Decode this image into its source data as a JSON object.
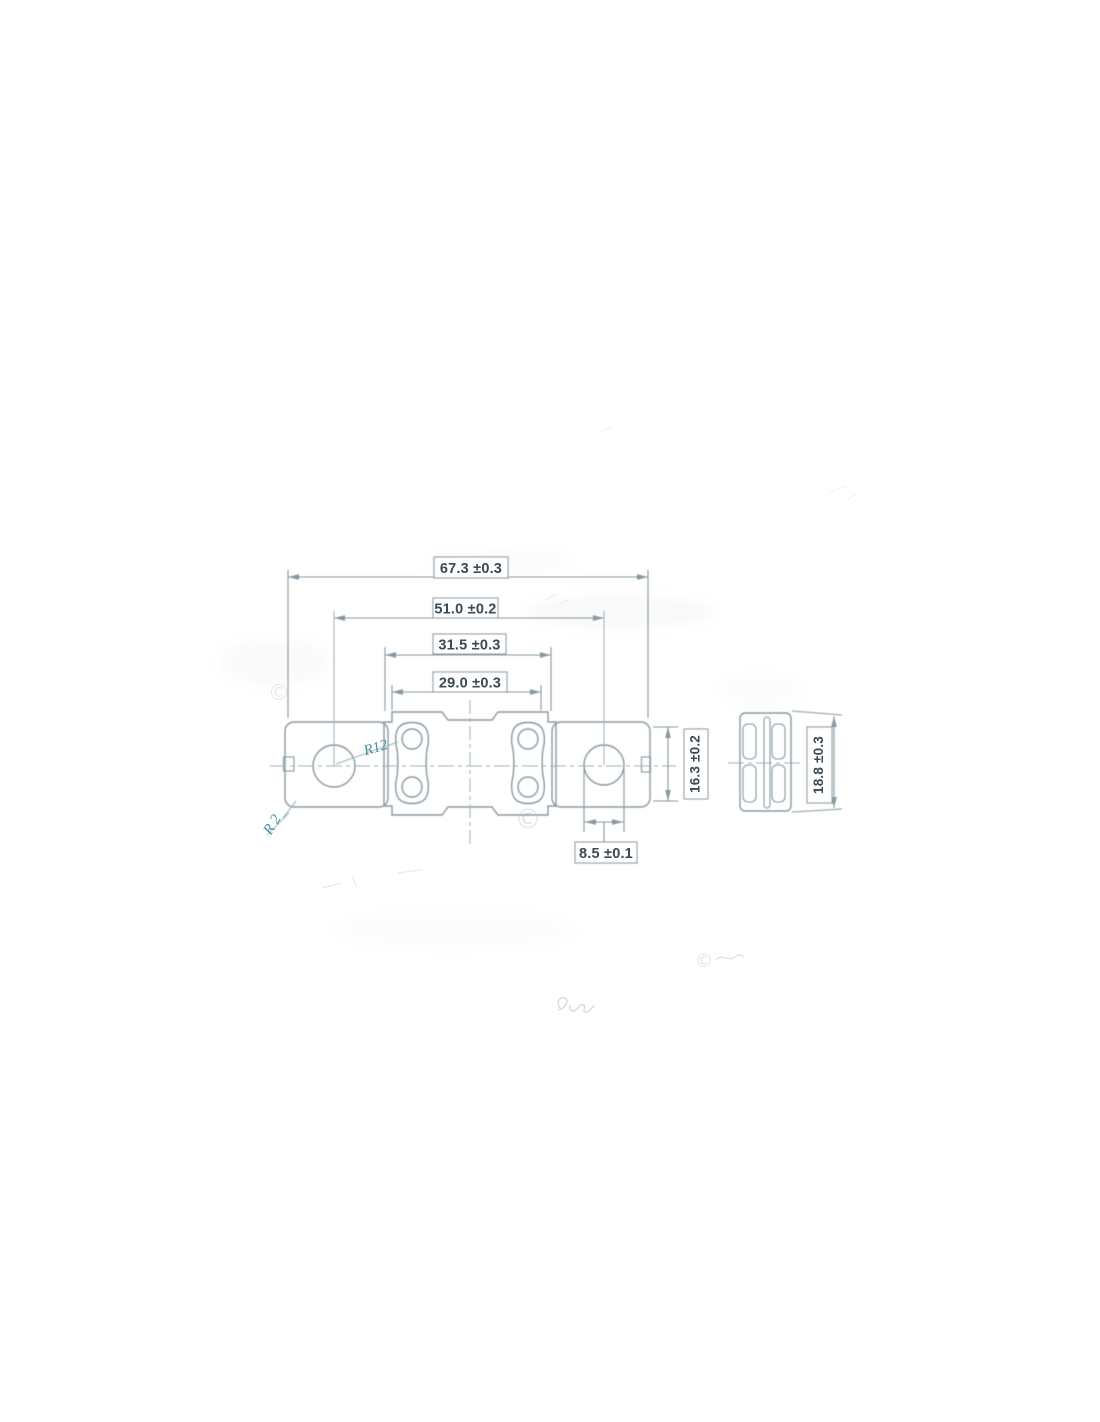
{
  "page": {
    "background": "#ffffff"
  },
  "colors": {
    "line": "#8798a0",
    "line_light": "#9fb0b6",
    "text": "#3a4a54",
    "accent_teal": "#4b8fa0",
    "watermark": "#9fb0b6"
  },
  "drawing": {
    "type": "technical-dimension-drawing",
    "subject": "bolt-down fuse, front and side views",
    "views": {
      "front": {
        "dimensions": [
          {
            "id": "overall_length",
            "label": "67.3 ±0.3"
          },
          {
            "id": "hole_center_spacing",
            "label": "51.0 ±0.2"
          },
          {
            "id": "center_outer_width",
            "label": "31.5 ±0.3"
          },
          {
            "id": "center_inner_width",
            "label": "29.0 ±0.3"
          },
          {
            "id": "terminal_height",
            "label": "16.3 ±0.2"
          },
          {
            "id": "mounting_hole_diameter",
            "label": "8.5 ±0.1"
          }
        ],
        "radius_callouts": [
          {
            "id": "hole_radius",
            "label": "R12"
          },
          {
            "id": "corner_radius",
            "label": "R 2"
          }
        ]
      },
      "side": {
        "dimensions": [
          {
            "id": "overall_height",
            "label": "18.8 ±0.3"
          }
        ]
      }
    },
    "watermarks": {
      "copyright_symbol": "©"
    }
  }
}
